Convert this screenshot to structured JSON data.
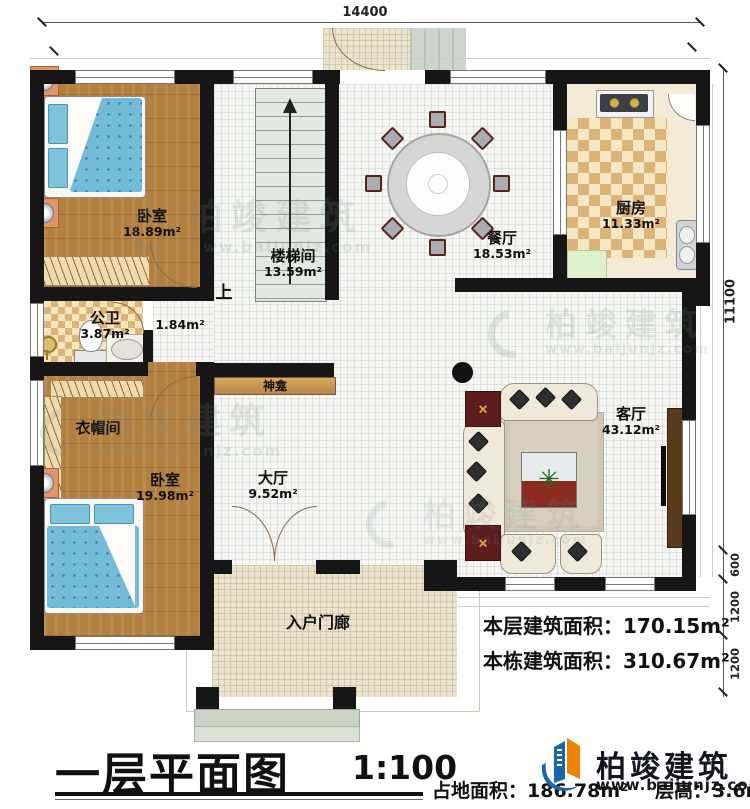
{
  "dims": {
    "width_top": "14400",
    "height_right": "11100",
    "seg_600": "600",
    "seg_1200a": "1200",
    "seg_1200b": "1200"
  },
  "rooms": {
    "bedroom_top": {
      "name": "卧室",
      "area": "18.89m²"
    },
    "stairwell": {
      "name": "楼梯间",
      "area": "13.59m²"
    },
    "dining": {
      "name": "餐厅",
      "area": "18.53m²"
    },
    "kitchen": {
      "name": "厨房",
      "area": "11.33m²"
    },
    "bathroom": {
      "name": "公卫",
      "area": "3.87m²"
    },
    "corridor": {
      "area": "1.84m²"
    },
    "cloakroom": {
      "name": "衣帽间"
    },
    "bedroom_bottom": {
      "name": "卧室",
      "area": "19.98m²"
    },
    "hall": {
      "name": "大厅",
      "area": "9.52m²"
    },
    "living": {
      "name": "客厅",
      "area": "43.12m²"
    },
    "porch": {
      "name": "入户门廊"
    },
    "shrine": {
      "name": "神龛"
    }
  },
  "annotations": {
    "stairs_up": "上"
  },
  "titleblock": {
    "title": "一层平面图",
    "scale": "1:100"
  },
  "stats": {
    "floor_area_label": "本层建筑面积：",
    "floor_area_value": "170.15m²",
    "building_area_label": "本栋建筑面积：",
    "building_area_value": "310.67m²",
    "site_area_label": "占地面积：",
    "site_area_value": "186.78m²",
    "floor_height_label": "层高：",
    "floor_height_value": "3.6m"
  },
  "brand": {
    "name": "柏竣建筑",
    "url": "www.baijunjz.com"
  },
  "colors": {
    "wall": "#161616",
    "wood": "#b2803f",
    "brand_blue": "#1767b0",
    "brand_orange": "#ef8200"
  }
}
